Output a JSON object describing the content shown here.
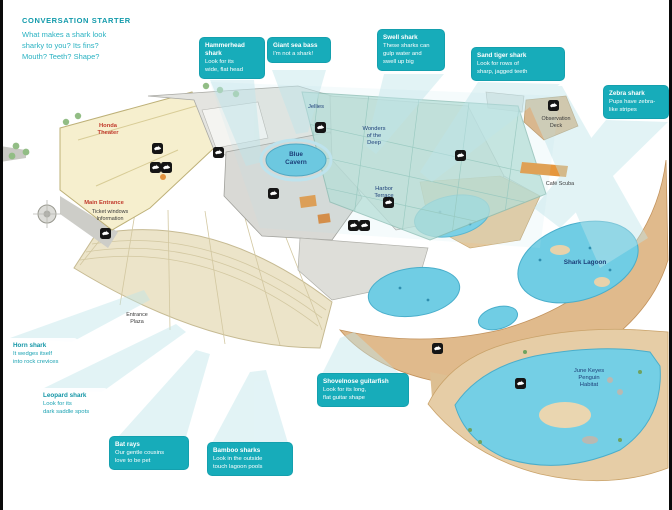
{
  "conversation_starter": {
    "heading": "CONVERSATION STARTER",
    "lines": [
      "What makes a shark look",
      "sharky to you? Its fins?",
      "Mouth? Teeth? Shape?"
    ]
  },
  "callouts": [
    {
      "id": "hammerhead",
      "title": "Hammerhead shark",
      "lines": [
        "Look for its",
        "wide, flat head"
      ]
    },
    {
      "id": "sea-bass",
      "title": "Giant sea bass",
      "lines": [
        "I'm not a shark!"
      ]
    },
    {
      "id": "swell",
      "title": "Swell shark",
      "lines": [
        "These sharks can",
        "gulp water and",
        "swell up big"
      ]
    },
    {
      "id": "sand-tiger",
      "title": "Sand tiger shark",
      "lines": [
        "Look for rows of",
        "sharp, jagged teeth"
      ]
    },
    {
      "id": "zebra",
      "title": "Zebra shark",
      "lines": [
        "Pups have zebra-",
        "like stripes"
      ]
    },
    {
      "id": "horn",
      "title": "Horn shark",
      "lines": [
        "It wedges itself",
        "into rock crevices"
      ]
    },
    {
      "id": "leopard",
      "title": "Leopard shark",
      "lines": [
        "Look for its",
        "dark saddle spots"
      ]
    },
    {
      "id": "bat-rays",
      "title": "Bat rays",
      "lines": [
        "Our gentle cousins",
        "love to be pet"
      ]
    },
    {
      "id": "bamboo",
      "title": "Bamboo sharks",
      "lines": [
        "Look in the outside",
        "touch lagoon pools"
      ]
    },
    {
      "id": "guitarfish",
      "title": "Shovelnose guitarfish",
      "lines": [
        "Look for its long,",
        "flat guitar shape"
      ]
    }
  ],
  "map": {
    "labels": [
      {
        "text": "Honda\nTheater"
      },
      {
        "text": "Main Entrance"
      },
      {
        "text": "Ticket windows\nInformation"
      },
      {
        "text": "Blue\nCavern"
      },
      {
        "text": "Jellies"
      },
      {
        "text": "Wonders\nof the\nDeep"
      },
      {
        "text": "Harbor\nTerrace"
      },
      {
        "text": "Shark Lagoon"
      },
      {
        "text": "June Keyes\nPenguin\nHabitat"
      },
      {
        "text": "Observation\nDeck"
      },
      {
        "text": "Entrance\nPlaza"
      },
      {
        "text": "Café Scuba"
      }
    ]
  },
  "icons": {
    "shark_marker": "shark-silhouette",
    "callout_ray": "pointer-wedge"
  },
  "colors": {
    "accent_teal": "#17acba",
    "ray_teal": "#bfe5ea",
    "pool_blue": "#70cde4",
    "sand": "#e0ba8c",
    "navy_label": "#1c3e78",
    "red_label": "#c13a2c",
    "plaza": "#ece4c9",
    "glass_roof": "#b5ddd4"
  }
}
